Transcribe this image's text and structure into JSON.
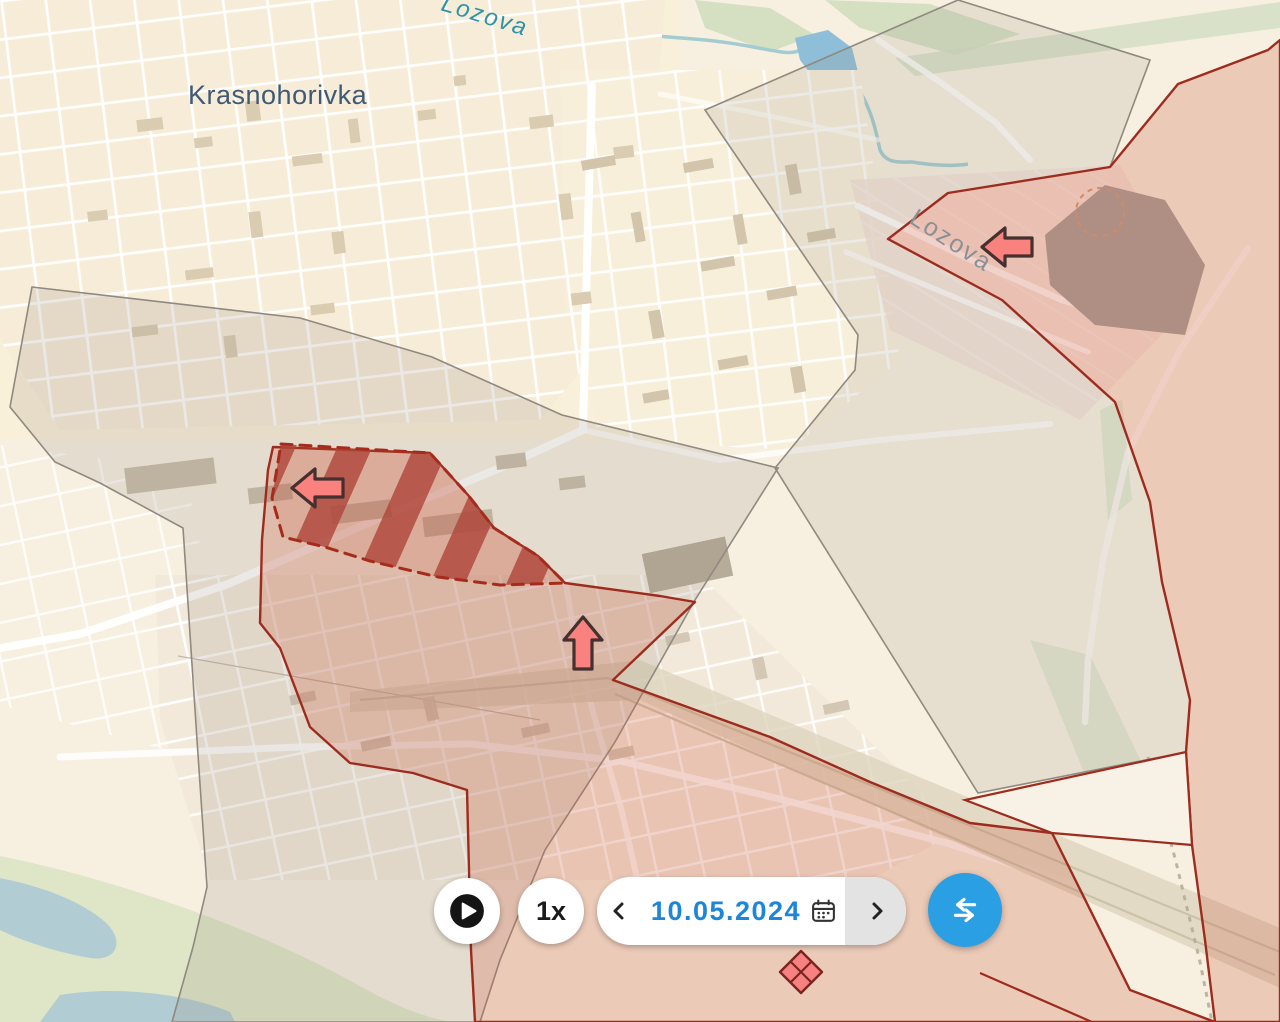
{
  "app": {
    "type": "interactive frontline map viewer"
  },
  "map": {
    "labels": {
      "city": "Krasnohorivka",
      "street": "Lozova",
      "river": "Lozova"
    },
    "zones": [
      {
        "name": "gray-zone-west",
        "kind": "gray/contested zone",
        "stroke": "#8f897f"
      },
      {
        "name": "gray-zone-east",
        "kind": "gray/contested zone",
        "stroke": "#8f897f"
      },
      {
        "name": "occupied-zone-east",
        "kind": "occupied territory",
        "stroke": "#9e2c1e"
      },
      {
        "name": "occupied-zone-south",
        "kind": "occupied territory",
        "stroke": "#9e2c1e"
      },
      {
        "name": "advance-zone",
        "kind": "hatched advance area with dashed border",
        "stroke": "#a52c1c"
      }
    ],
    "markers": [
      {
        "type": "advance-arrow",
        "direction": "left",
        "x": 315,
        "y": 488
      },
      {
        "type": "advance-arrow",
        "direction": "up",
        "x": 583,
        "y": 643
      },
      {
        "type": "advance-arrow",
        "direction": "left",
        "x": 1006,
        "y": 247
      },
      {
        "type": "clash-diamond",
        "x": 801,
        "y": 972
      }
    ]
  },
  "controls": {
    "speed": "1x",
    "date": "10.05.2024",
    "icons": [
      "play-icon",
      "calendar-icon",
      "chevron-left-icon",
      "chevron-right-icon",
      "compare-arrows-icon"
    ]
  },
  "colors": {
    "accent_blue": "#2a9fe3",
    "date_blue": "#1d86d8",
    "occupied_red_border": "#9e2c1e",
    "occupied_red_fill": "rgba(206,93,69,0.26)",
    "gray_zone_border": "#8f897f",
    "arrow_pink": "#f9817e",
    "map_base": "#f7f0e1"
  }
}
